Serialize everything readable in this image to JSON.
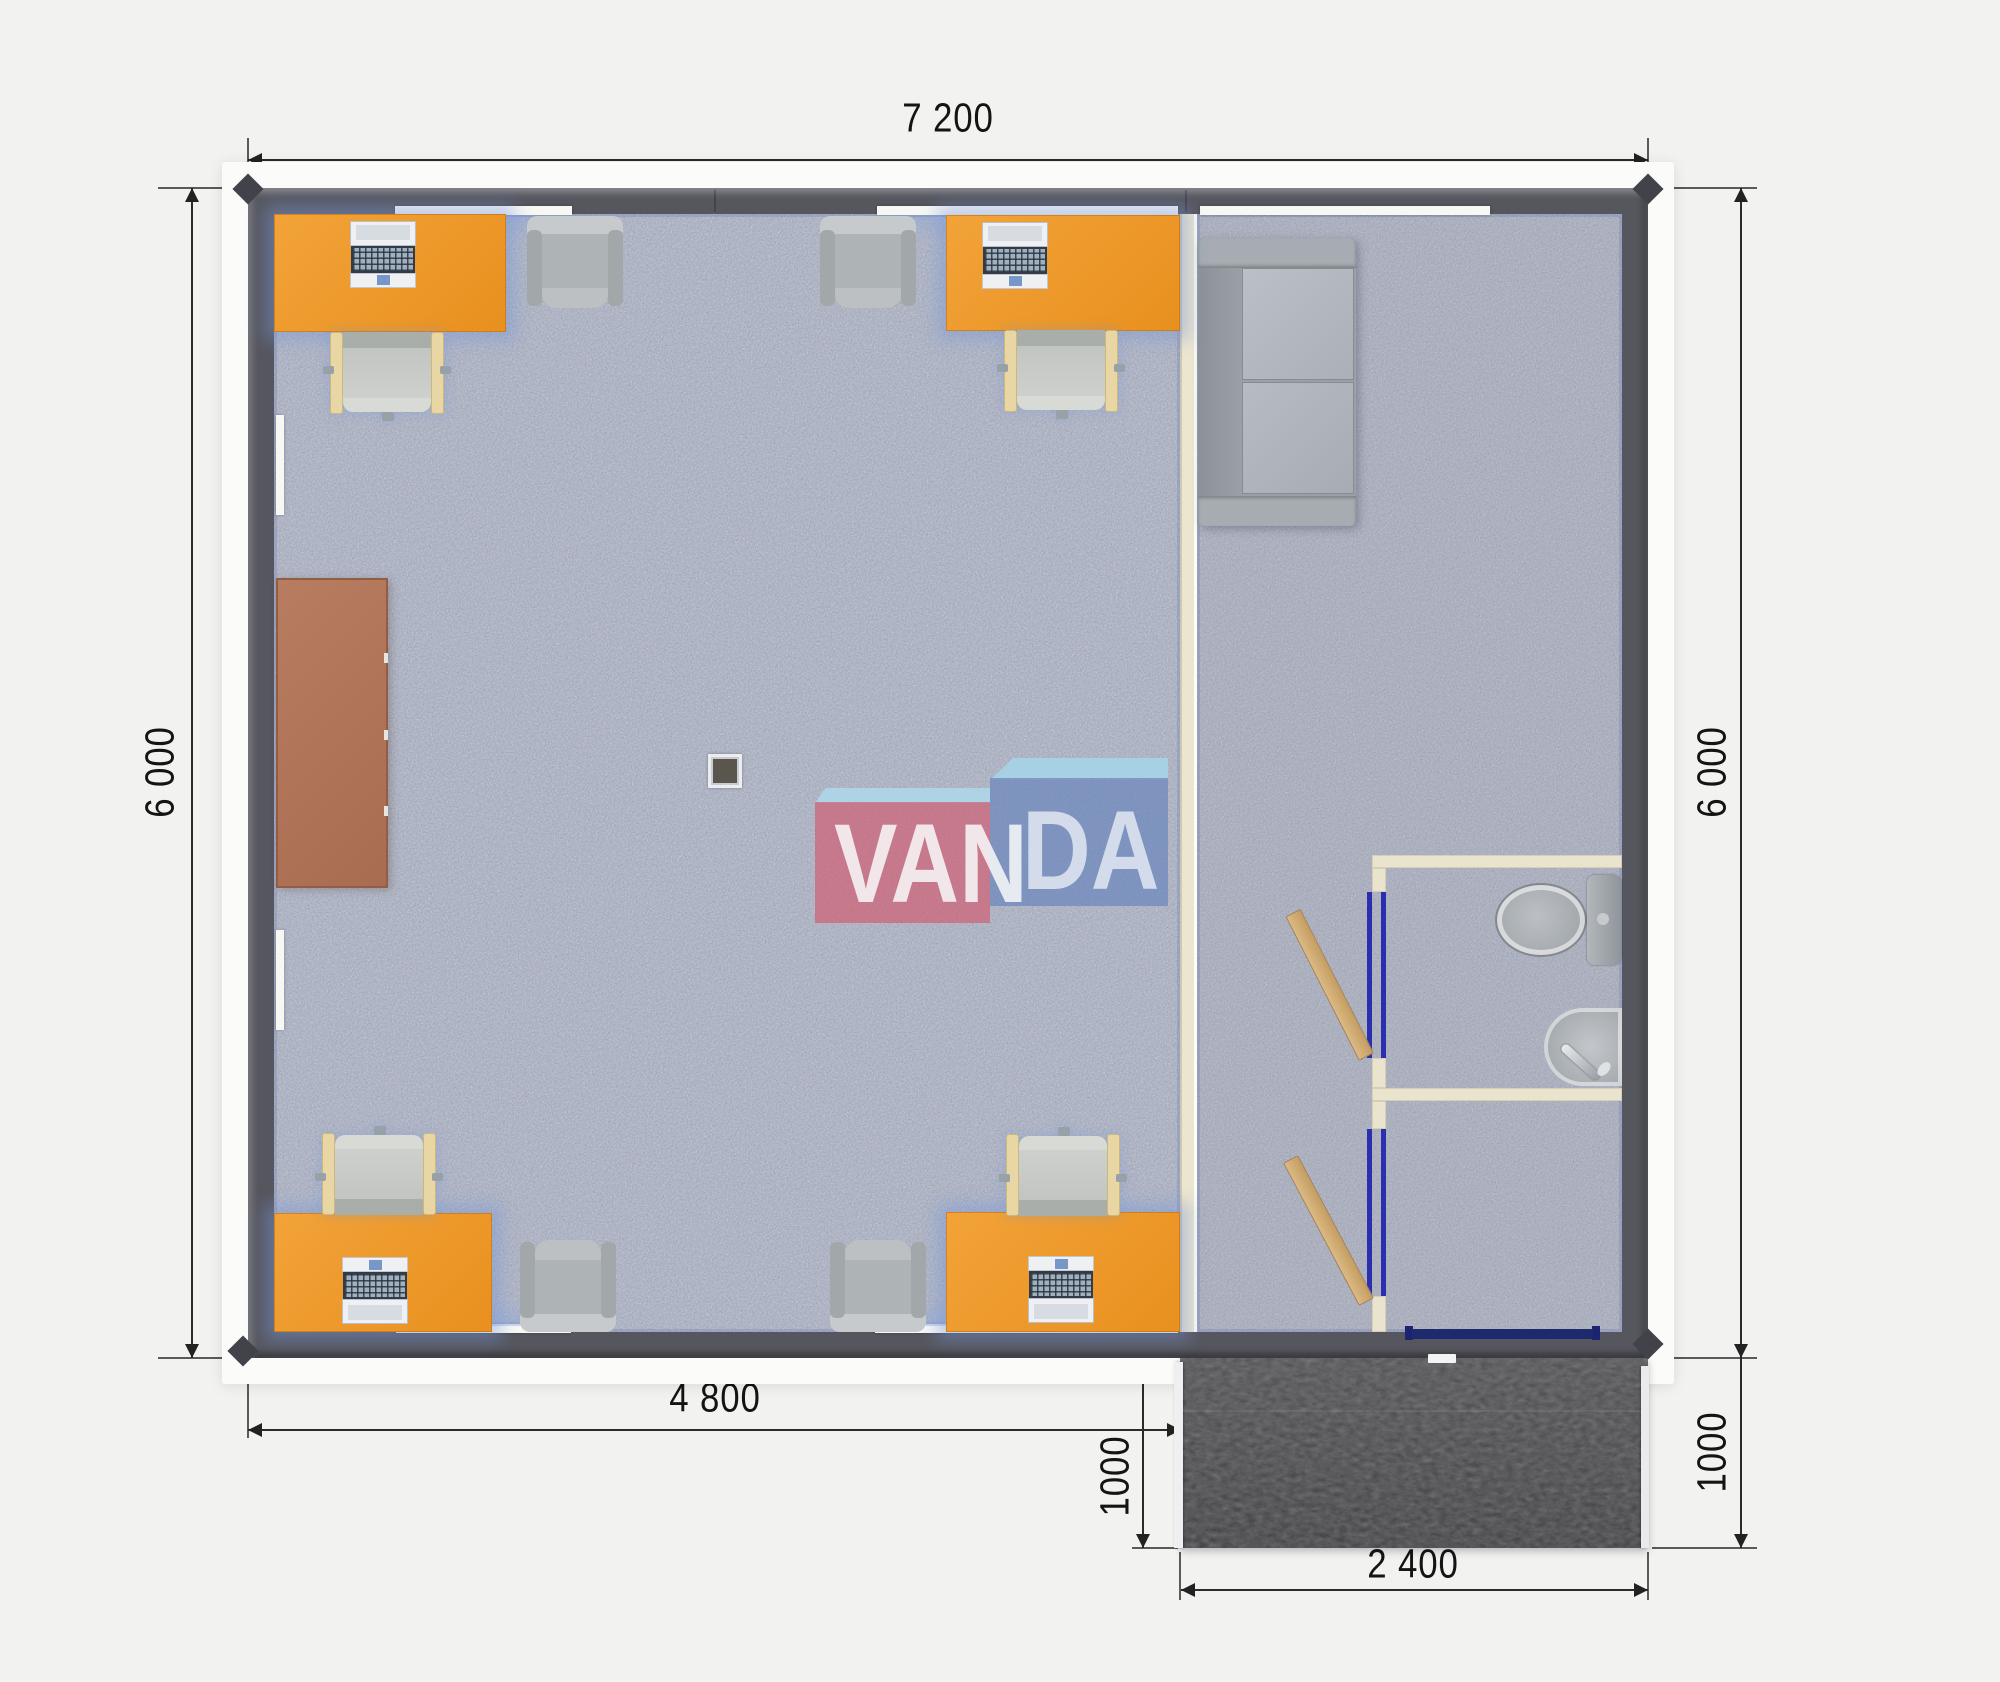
{
  "floor_plan": {
    "title": "office-module-floor-plan",
    "dimensions_mm": {
      "top": "7 200",
      "left": "6 000",
      "right": "6 000",
      "bottom": "4 800",
      "porch_depth_left": "1000",
      "porch_depth_right": "1000",
      "porch_width": "2 400"
    },
    "logo": {
      "left": "VAN",
      "right": "DA",
      "name": "VANDA"
    },
    "colors": {
      "desk_orange": "#ef9a30",
      "wall_dark": "#56565e",
      "partition_beige": "#ece5d0",
      "carpet_blue_gray": "#b5bac7",
      "door_wood": "#d3ae77",
      "door_frame_blue": "#2b2fae",
      "logo_pink": "#d25c70",
      "logo_blue": "#6c88be",
      "logo_light_blue": "#a8d3e7",
      "meeting_table_brown": "#b3765b",
      "porch_dark": "#4b4b4d"
    },
    "furniture_counts": {
      "desks": 4,
      "computers": 4,
      "office_chairs": 4,
      "armchairs": 4,
      "sofa": 1,
      "toilet": 1,
      "sink": 1,
      "meeting_table": 1,
      "column": 1,
      "doors": 2
    }
  }
}
